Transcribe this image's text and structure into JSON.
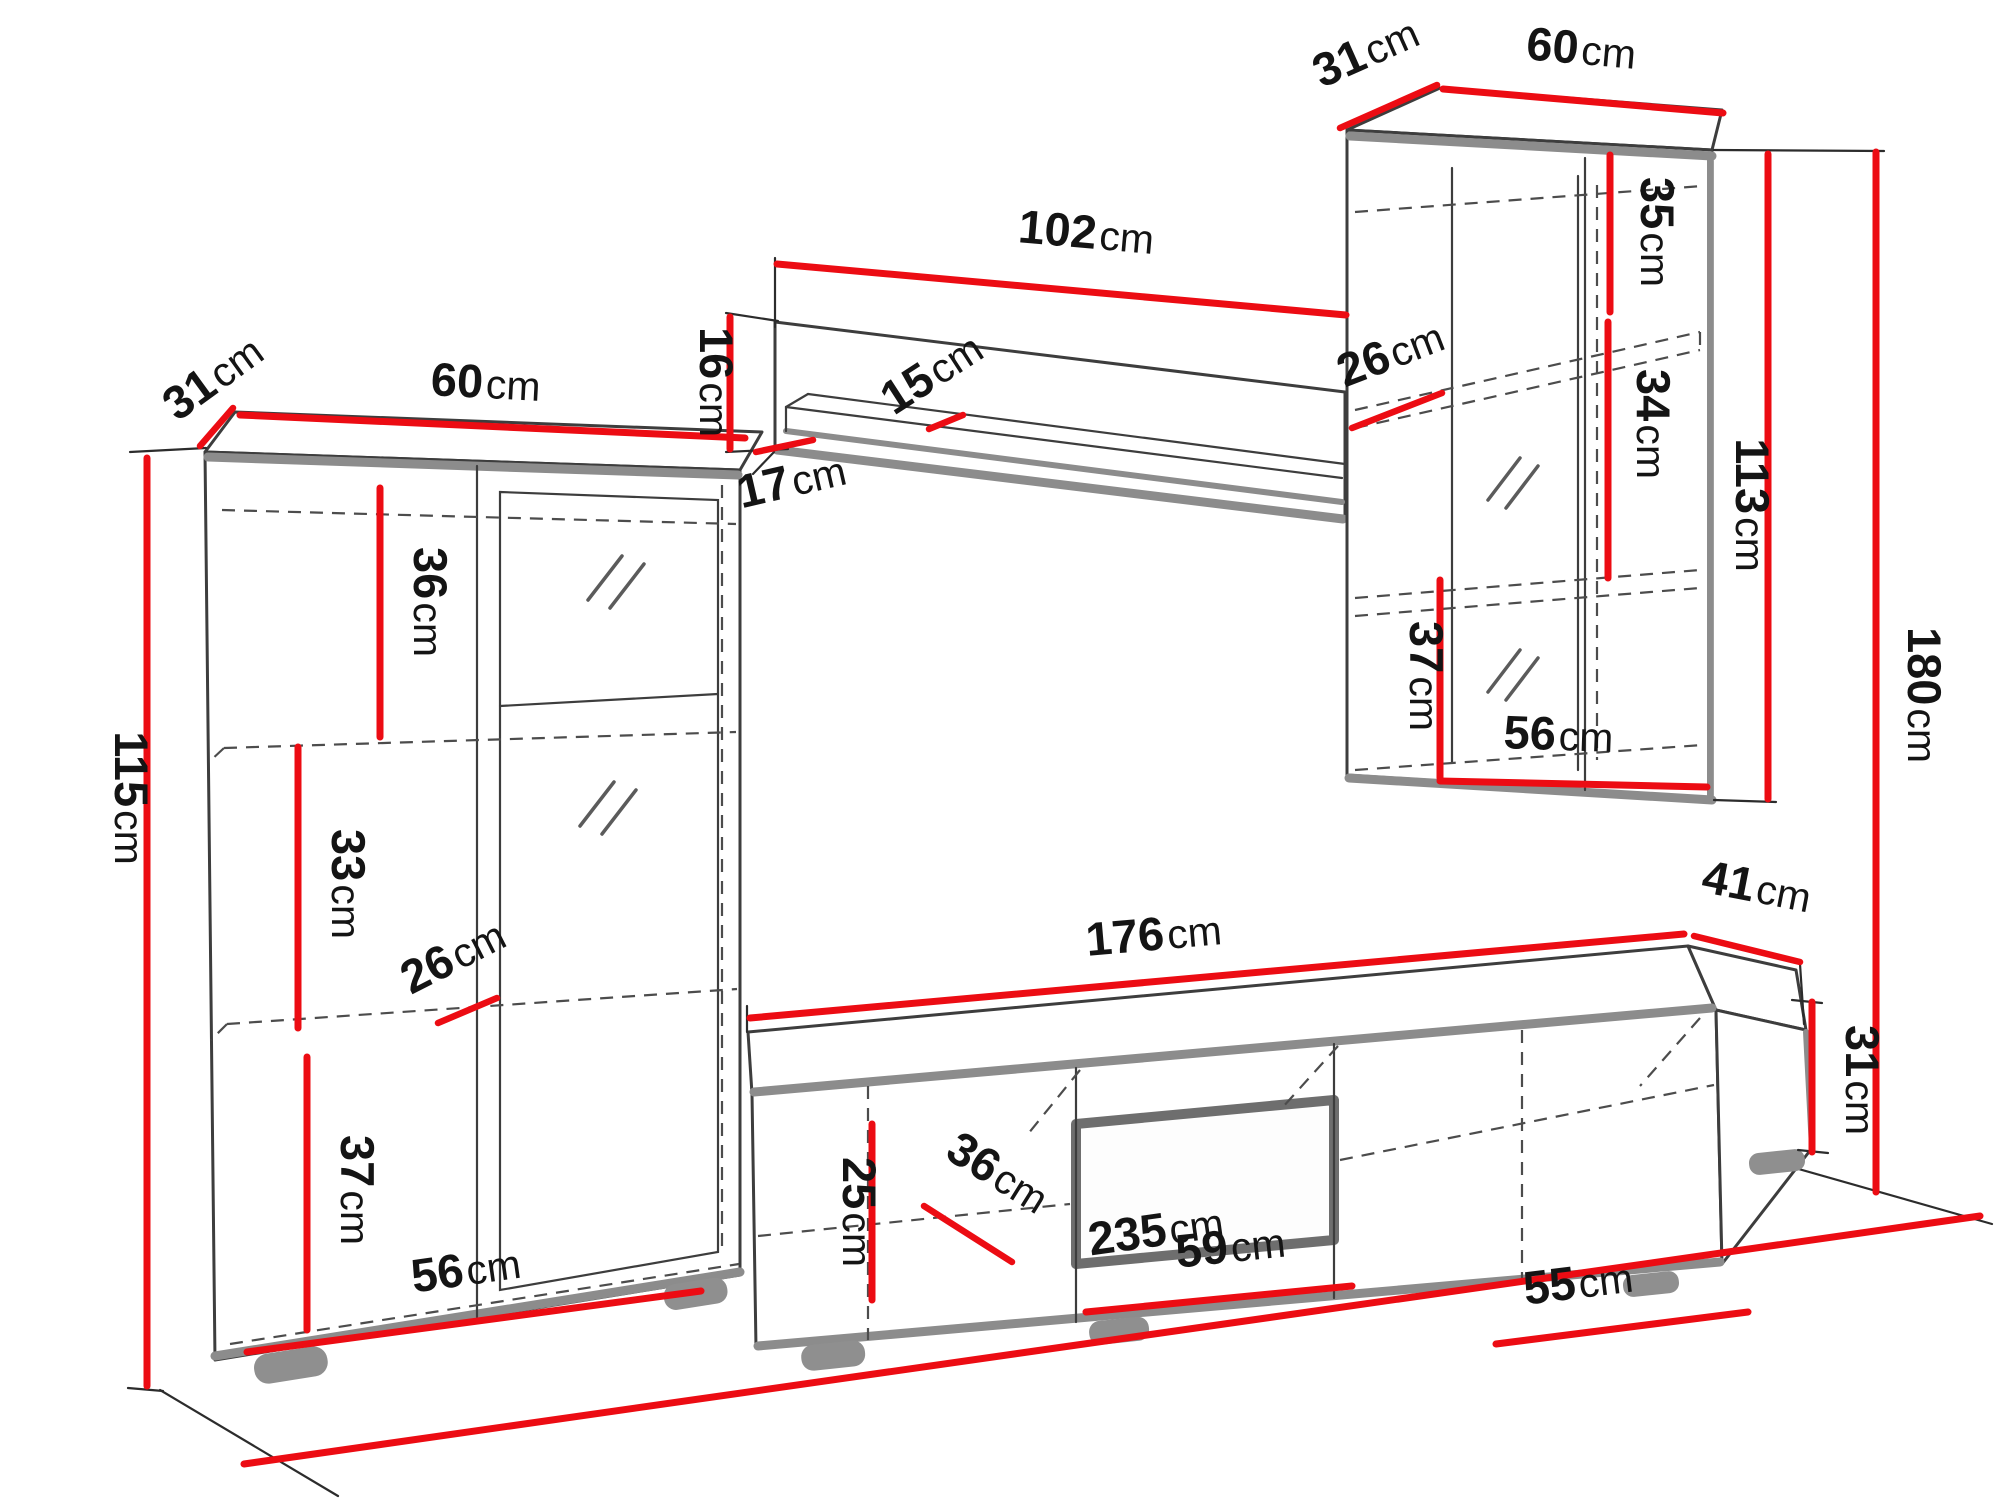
{
  "diagram": {
    "unit": "cm",
    "left_cabinet": {
      "depth": {
        "v": "31",
        "u": "cm"
      },
      "width": {
        "v": "60",
        "u": "cm"
      },
      "height": {
        "v": "115",
        "u": "cm"
      },
      "upper_shelf": {
        "v": "36",
        "u": "cm"
      },
      "middle_shelf": {
        "v": "33",
        "u": "cm"
      },
      "shelf_depth": {
        "v": "26",
        "u": "cm"
      },
      "lower_section": {
        "v": "37",
        "u": "cm"
      },
      "base_width": {
        "v": "56",
        "u": "cm"
      }
    },
    "wall_shelf": {
      "width": {
        "v": "102",
        "u": "cm"
      },
      "height": {
        "v": "16",
        "u": "cm"
      },
      "end_depth": {
        "v": "17",
        "u": "cm"
      },
      "board_depth": {
        "v": "15",
        "u": "cm"
      }
    },
    "wall_cabinet": {
      "depth": {
        "v": "31",
        "u": "cm"
      },
      "width": {
        "v": "60",
        "u": "cm"
      },
      "upper_section": {
        "v": "35",
        "u": "cm"
      },
      "shelf_depth": {
        "v": "26",
        "u": "cm"
      },
      "middle_section": {
        "v": "34",
        "u": "cm"
      },
      "height": {
        "v": "113",
        "u": "cm"
      },
      "lower_section": {
        "v": "37",
        "u": "cm"
      },
      "base_width": {
        "v": "56",
        "u": "cm"
      },
      "total_height": {
        "v": "180",
        "u": "cm"
      }
    },
    "tv_stand": {
      "width": {
        "v": "176",
        "u": "cm"
      },
      "depth": {
        "v": "41",
        "u": "cm"
      },
      "height": {
        "v": "31",
        "u": "cm"
      },
      "interior_height": {
        "v": "25",
        "u": "cm"
      },
      "interior_depth": {
        "v": "36",
        "u": "cm"
      },
      "niche_width": {
        "v": "59",
        "u": "cm"
      },
      "right_compartment": {
        "v": "55",
        "u": "cm"
      },
      "total_width": {
        "v": "235",
        "u": "cm"
      }
    }
  }
}
